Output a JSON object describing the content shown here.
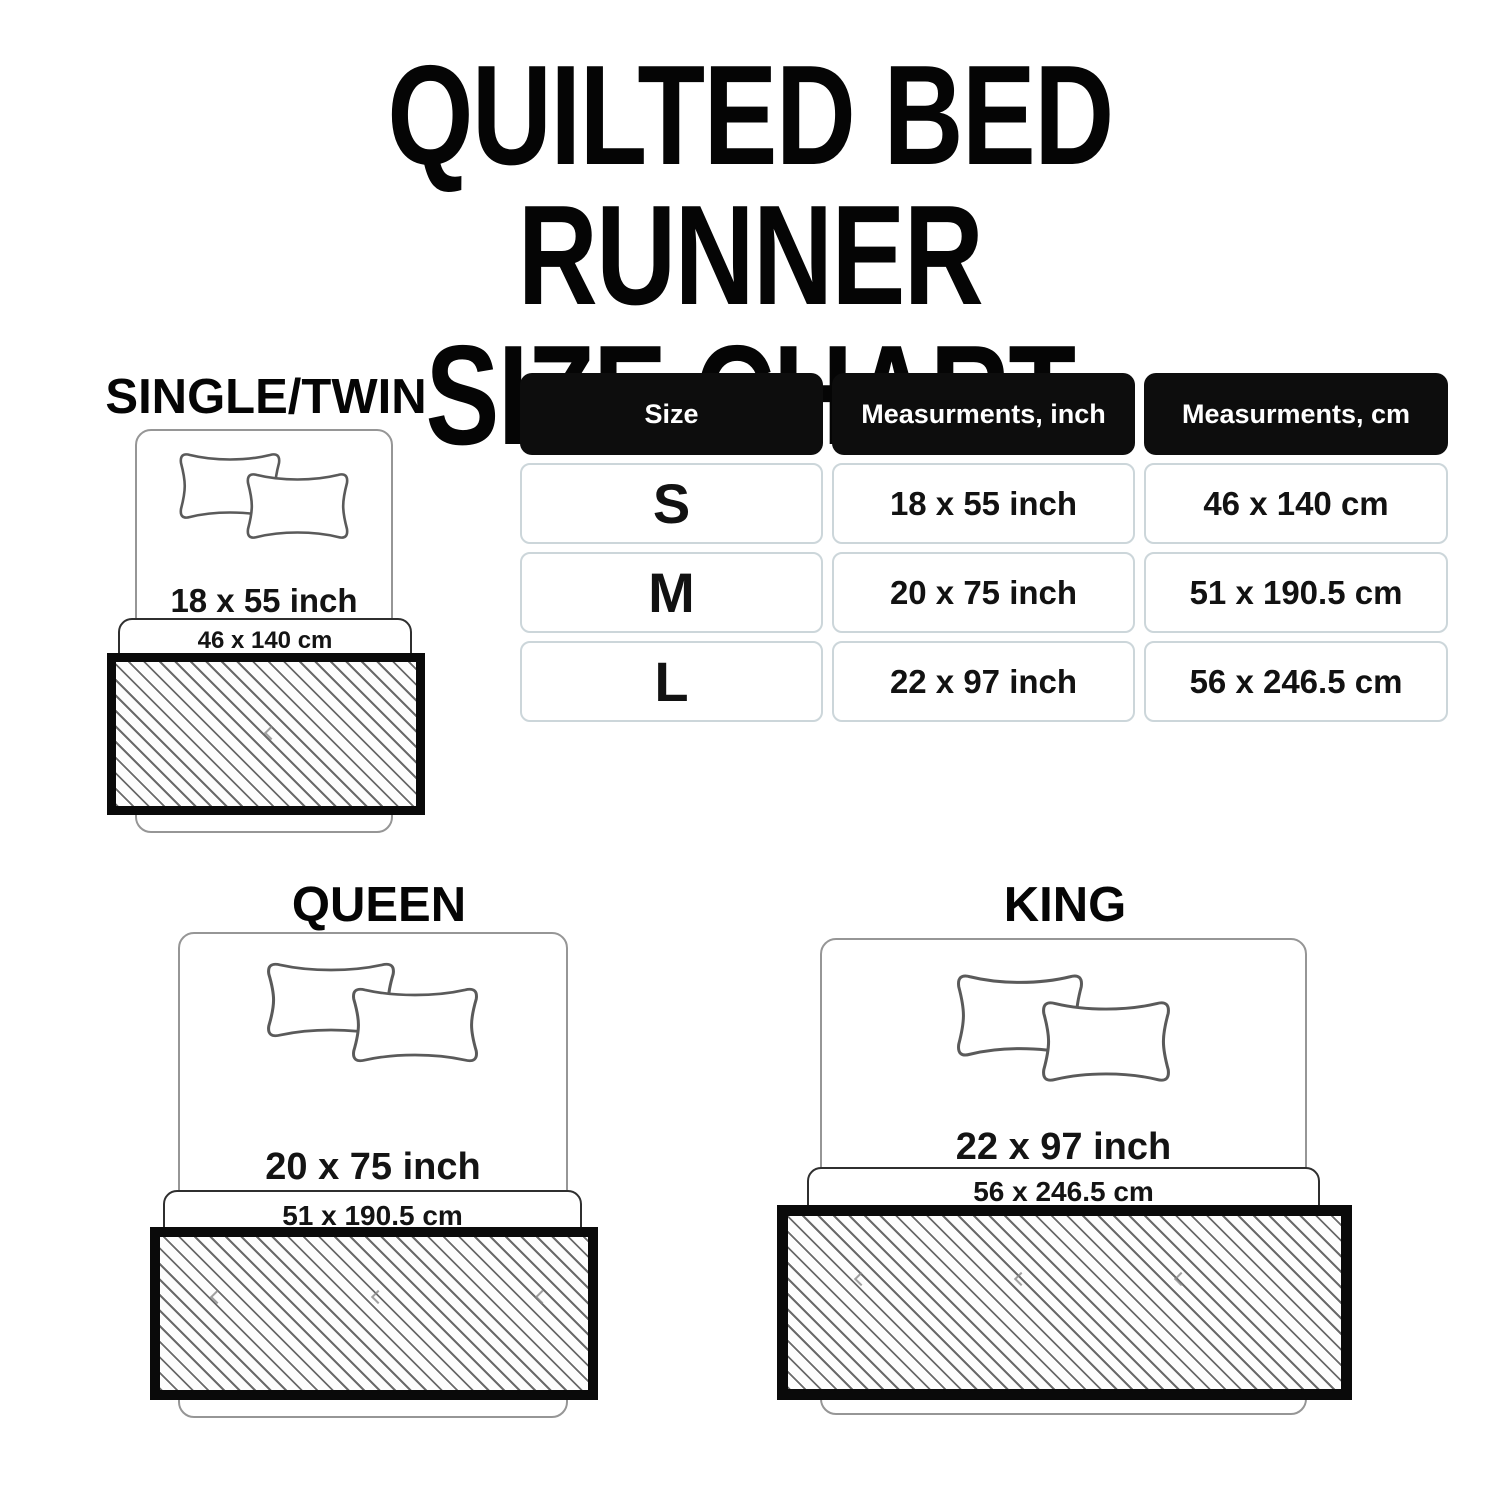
{
  "title": {
    "line1": "QUILTED BED RUNNER",
    "line2": "SIZE CHART",
    "full": "QUILTED BED RUNNER\nSIZE CHART"
  },
  "table": {
    "headers": [
      "Size",
      "Measurments, inch",
      "Measurments, cm"
    ],
    "rows": [
      {
        "size": "S",
        "inch": "18 x 55 inch",
        "cm": "46 x 140 cm"
      },
      {
        "size": "M",
        "inch": "20 x 75 inch",
        "cm": "51 x 190.5 cm"
      },
      {
        "size": "L",
        "inch": "22 x 97 inch",
        "cm": "56 x 246.5 cm"
      }
    ]
  },
  "diagrams": [
    {
      "id": "single",
      "label": "SINGLE/TWIN",
      "inch": "18 x 55 inch",
      "cm": "46 x 140 cm"
    },
    {
      "id": "queen",
      "label": "QUEEN",
      "inch": "20 x 75 inch",
      "cm": "51 x 190.5 cm"
    },
    {
      "id": "king",
      "label": "KING",
      "inch": "22 x 97 inch",
      "cm": "56 x 246.5 cm"
    }
  ],
  "chart_data": {
    "type": "table",
    "title": "QUILTED BED RUNNER SIZE CHART",
    "columns": [
      "Size",
      "Measurments, inch",
      "Measurments, cm"
    ],
    "rows": [
      [
        "S",
        "18 x 55 inch",
        "46 x 140 cm"
      ],
      [
        "M",
        "20 x 75 inch",
        "51 x 190.5 cm"
      ],
      [
        "L",
        "22 x 97 inch",
        "56 x 246.5 cm"
      ]
    ]
  },
  "colors": {
    "background": "#ffffff",
    "text": "#111111",
    "table_header_bg": "#0d0d0d",
    "table_header_text": "#ffffff",
    "table_cell_border": "#ccd6da",
    "bed_outline": "#969696",
    "pillow_outline": "#5a5a5a",
    "cm_box_border": "#2f2f2f",
    "runner_border": "#0a0a0a",
    "hatch_line": "#6a6a6a"
  },
  "icons": {
    "pillow": "pillow-icon",
    "runner": "hatched-runner-swatch"
  }
}
